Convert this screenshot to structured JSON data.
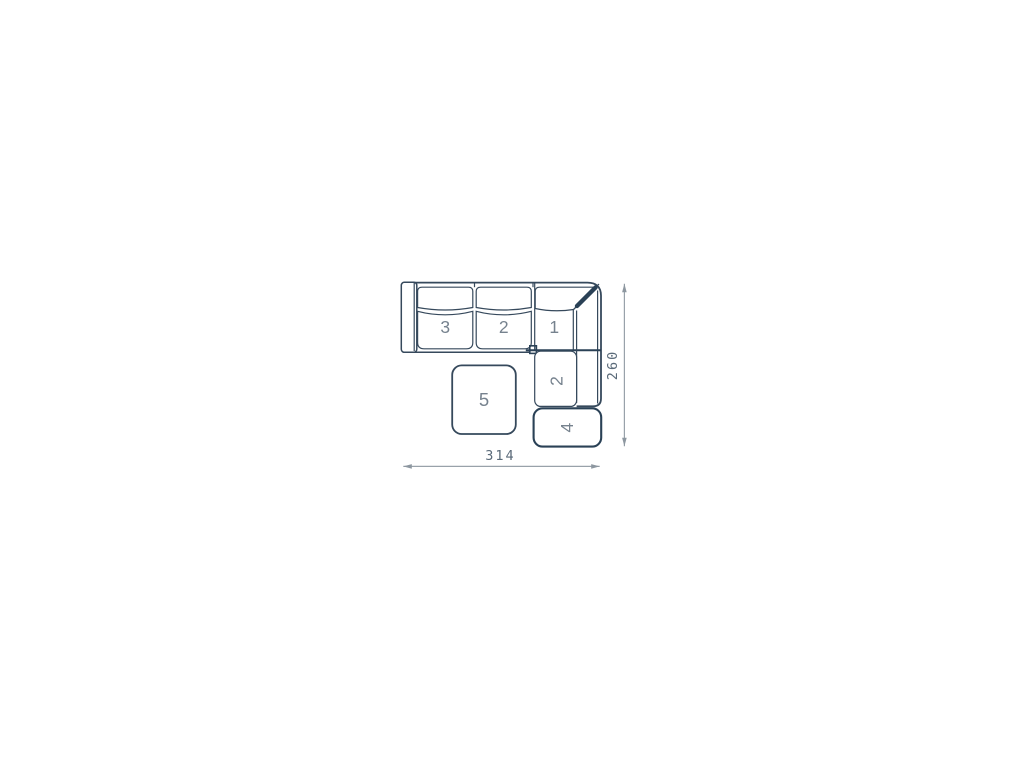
{
  "diagram": {
    "type": "sectional-sofa-top-view-dimension-drawing",
    "seat_labels": {
      "seat3": "3",
      "seat2_top": "2",
      "seat1_corner": "1",
      "chaise2": "2",
      "module4": "4",
      "ottoman5": "5"
    },
    "dimensions": {
      "width": "314",
      "height": "260"
    },
    "colors": {
      "outline": "#36495c",
      "dark_accent": "#2a4156",
      "seat_number_text": "#76828e",
      "dimension_text": "#5b6b7a",
      "dimension_line": "#99a2aa",
      "background": "#ffffff",
      "fill": "#ffffff"
    }
  }
}
